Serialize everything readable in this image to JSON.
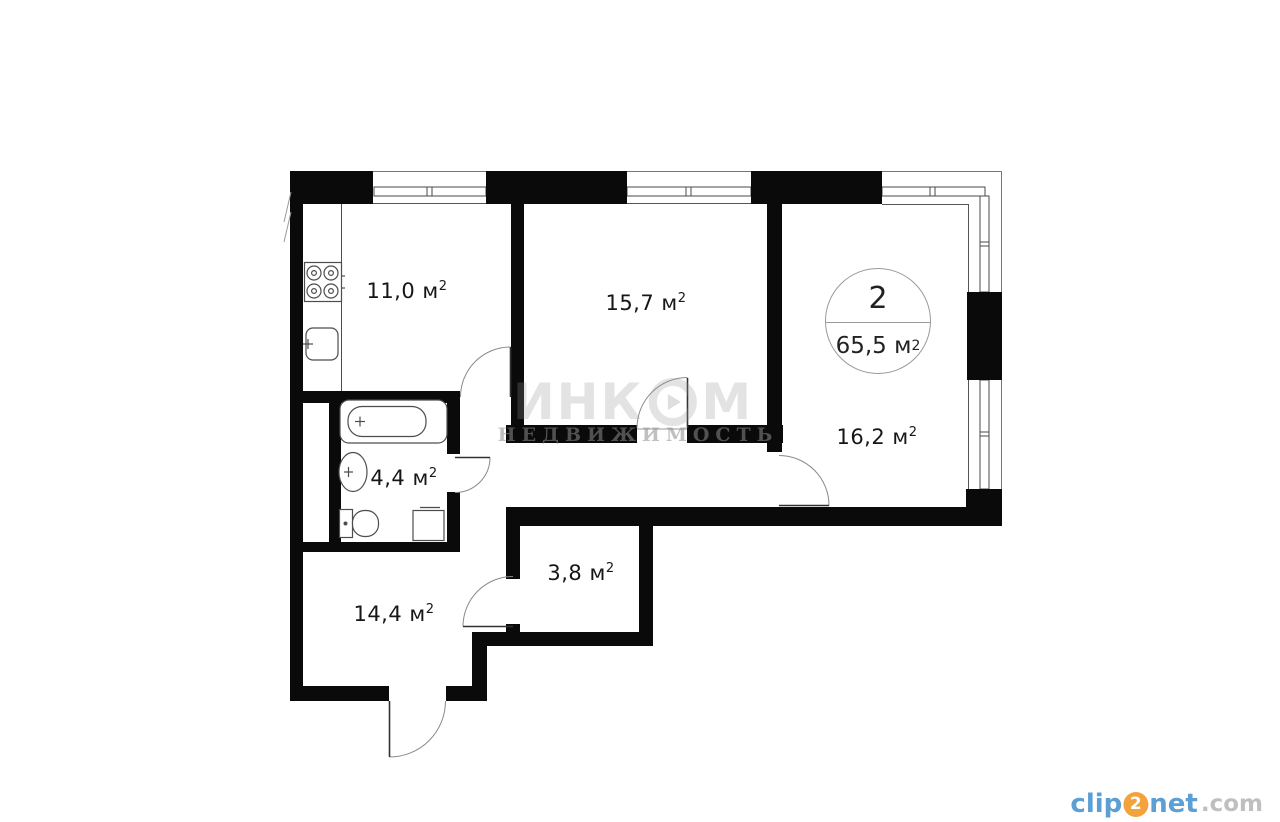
{
  "floorplan": {
    "unit": "м",
    "sup": "2",
    "rooms": {
      "kitchen": {
        "area": "11,0"
      },
      "bedroom": {
        "area": "15,7"
      },
      "living": {
        "area": "16,2"
      },
      "bathroom": {
        "area": "4,4"
      },
      "wardrobe": {
        "area": "3,8"
      },
      "hallway": {
        "area": "14,4"
      }
    },
    "badge": {
      "room_count": "2",
      "total_area": "65,5"
    },
    "colors": {
      "wall": "#0a0a0a",
      "logo_blue": "#5b9fd4",
      "logo_orange": "#f2a33c"
    }
  },
  "watermark": {
    "brand_part1": "ИНК",
    "brand_part2": "М",
    "subtitle": "НЕДВИЖИМОСТЬ"
  },
  "logo": {
    "clip": "clip",
    "two": "2",
    "net": "net",
    "dotcom": ".com"
  }
}
